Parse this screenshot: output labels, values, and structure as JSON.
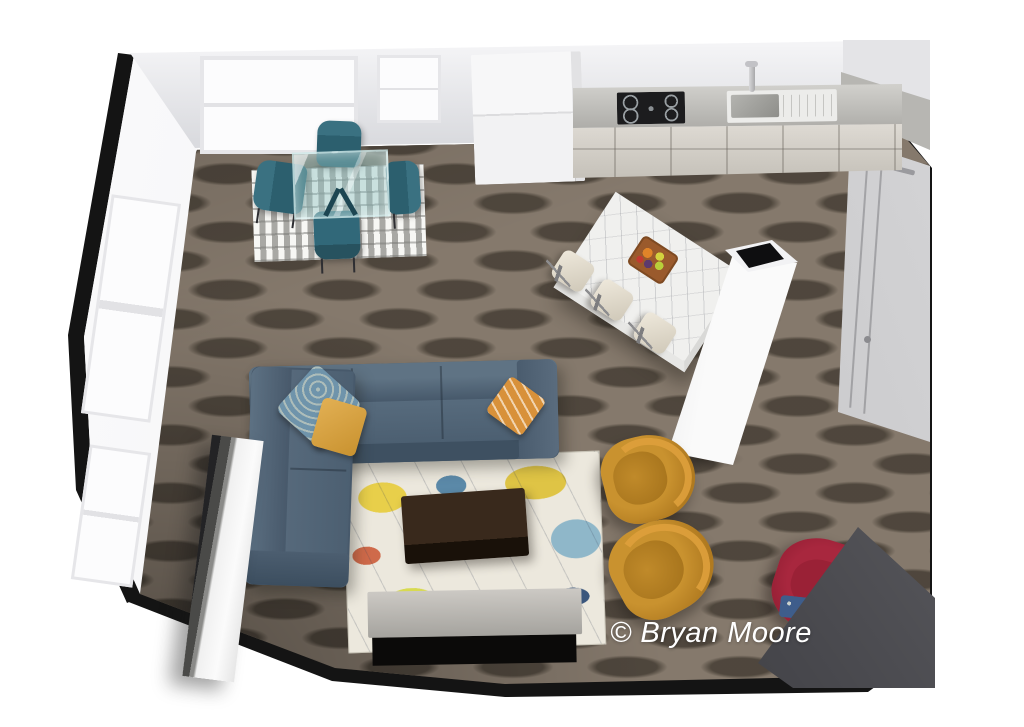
{
  "watermark": {
    "text": "© Bryan Moore",
    "color": "#ffffff"
  },
  "palette": {
    "page_bg": "#ffffff",
    "floor_base": "#85796c",
    "floor_plank_dark": "#4c443a",
    "wall_white": "#ececee",
    "wall_gray": "#dadbdf",
    "wall_cut_black": "#141414",
    "window_glass": "#fcfcfd",
    "counter_gray": "#b7b6b2",
    "cabinet_wood": "#c6c2ba",
    "cooktop_black": "#1c1c1e",
    "island_marble": "#f0f0ee",
    "stool_cream": "#cfc8b8",
    "column_white": "#fafafa",
    "sofa_blue": "#47596b",
    "pillow_blue": "#6f94ab",
    "pillow_mustard": "#c9922f",
    "pillow_orange": "#d8913a",
    "rug_living_base": "#ece8dd",
    "coffee_table_dark": "#32281d",
    "console_gray": "#a5a39e",
    "console_black": "#0b0a09",
    "armchair_mustard": "#b07a20",
    "accent_chair_red": "#8c1c30",
    "dining_chair_teal": "#2d6271",
    "dining_rug_gray": "#bdbcb8",
    "door_gray": "#bfbfc1",
    "corner_wall_dark": "#47474c"
  },
  "scene": {
    "description": "3D top-down render of an open-plan living room, dining area and kitchen",
    "furniture": [
      {
        "id": "dining-table",
        "label": "Glass dining table"
      },
      {
        "id": "dining-chairs",
        "label": "Teal dining chairs",
        "count": 4
      },
      {
        "id": "dining-rug",
        "label": "Gray woven rug"
      },
      {
        "id": "kitchen-counter",
        "label": "Kitchen counter with cooktop and sink"
      },
      {
        "id": "tall-cabinet",
        "label": "Tall white cabinet"
      },
      {
        "id": "kitchen-island",
        "label": "Marble kitchen island"
      },
      {
        "id": "bar-stools",
        "label": "Cream bar stools",
        "count": 3
      },
      {
        "id": "fruit-bowl",
        "label": "Fruit bowl"
      },
      {
        "id": "chimney-column",
        "label": "White chimney column"
      },
      {
        "id": "sectional-sofa",
        "label": "Blue sectional sofa"
      },
      {
        "id": "throw-pillows",
        "label": "Throw pillows",
        "count": 3
      },
      {
        "id": "area-rug",
        "label": "Abstract multicolor area rug"
      },
      {
        "id": "coffee-table",
        "label": "Dark wood coffee table"
      },
      {
        "id": "media-console",
        "label": "Media console"
      },
      {
        "id": "accent-armchairs",
        "label": "Mustard barrel armchairs",
        "count": 2
      },
      {
        "id": "red-armchair",
        "label": "Crimson armchair"
      },
      {
        "id": "tv-partition",
        "label": "White partition panel"
      },
      {
        "id": "interior-door",
        "label": "Gray interior door"
      }
    ]
  }
}
